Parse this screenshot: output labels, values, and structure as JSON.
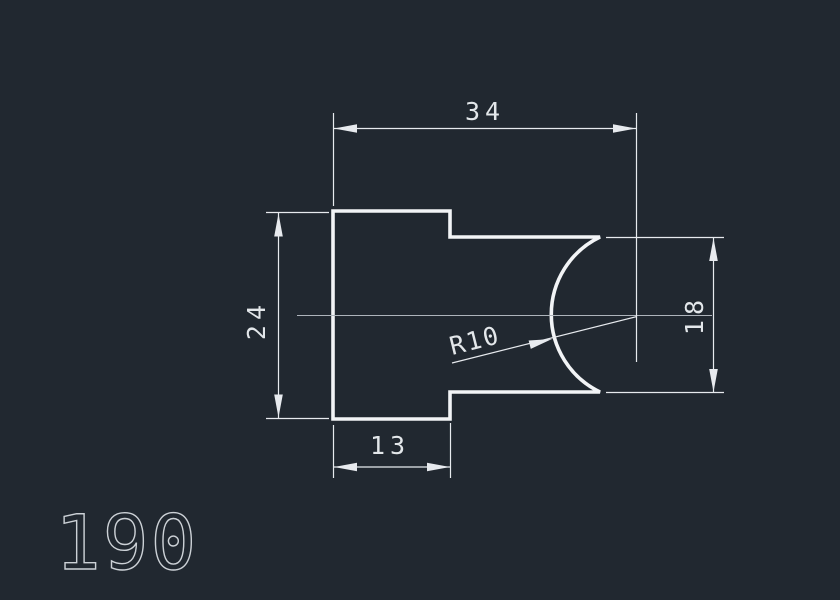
{
  "drawing": {
    "part_number": "190",
    "dimensions": {
      "total_width": {
        "label": "34"
      },
      "left_height": {
        "label": "24"
      },
      "right_height": {
        "label": "18"
      },
      "left_width": {
        "label": "13"
      },
      "notch_radius": {
        "label": "R10"
      }
    },
    "colors": {
      "background": "#212830",
      "outline": "#f2f4f6",
      "dimension_lines": "#e7eaee",
      "centerline": "#aeb4bb",
      "text": "#e3e7ea"
    }
  }
}
